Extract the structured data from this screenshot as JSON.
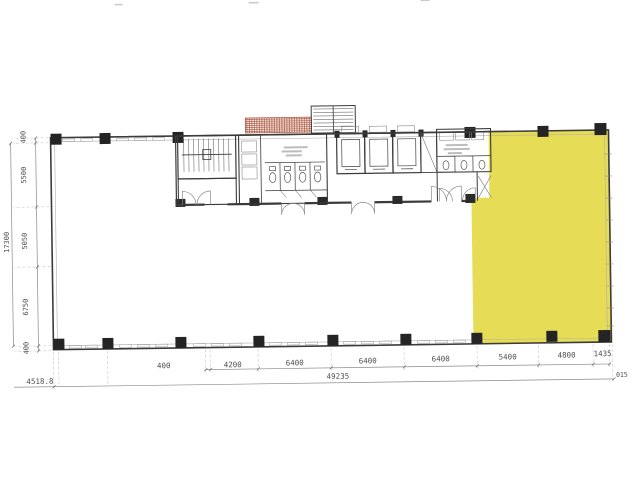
{
  "colors": {
    "highlight_fill": "#e7dc55",
    "hatch_red": "#b05a42",
    "wall_line": "#3b3b3b",
    "dim_line": "#8a8a8a"
  },
  "dimensions": {
    "left": {
      "total": "17300",
      "segments": [
        "400",
        "5500",
        "5050",
        "6750",
        "400"
      ]
    },
    "bottom": {
      "segments": [
        "400",
        "4200",
        "6400",
        "6400",
        "6400",
        "5400",
        "4800",
        "1435"
      ],
      "overall": "49235",
      "left_figure": "4518.8",
      "right_note": "015"
    }
  }
}
